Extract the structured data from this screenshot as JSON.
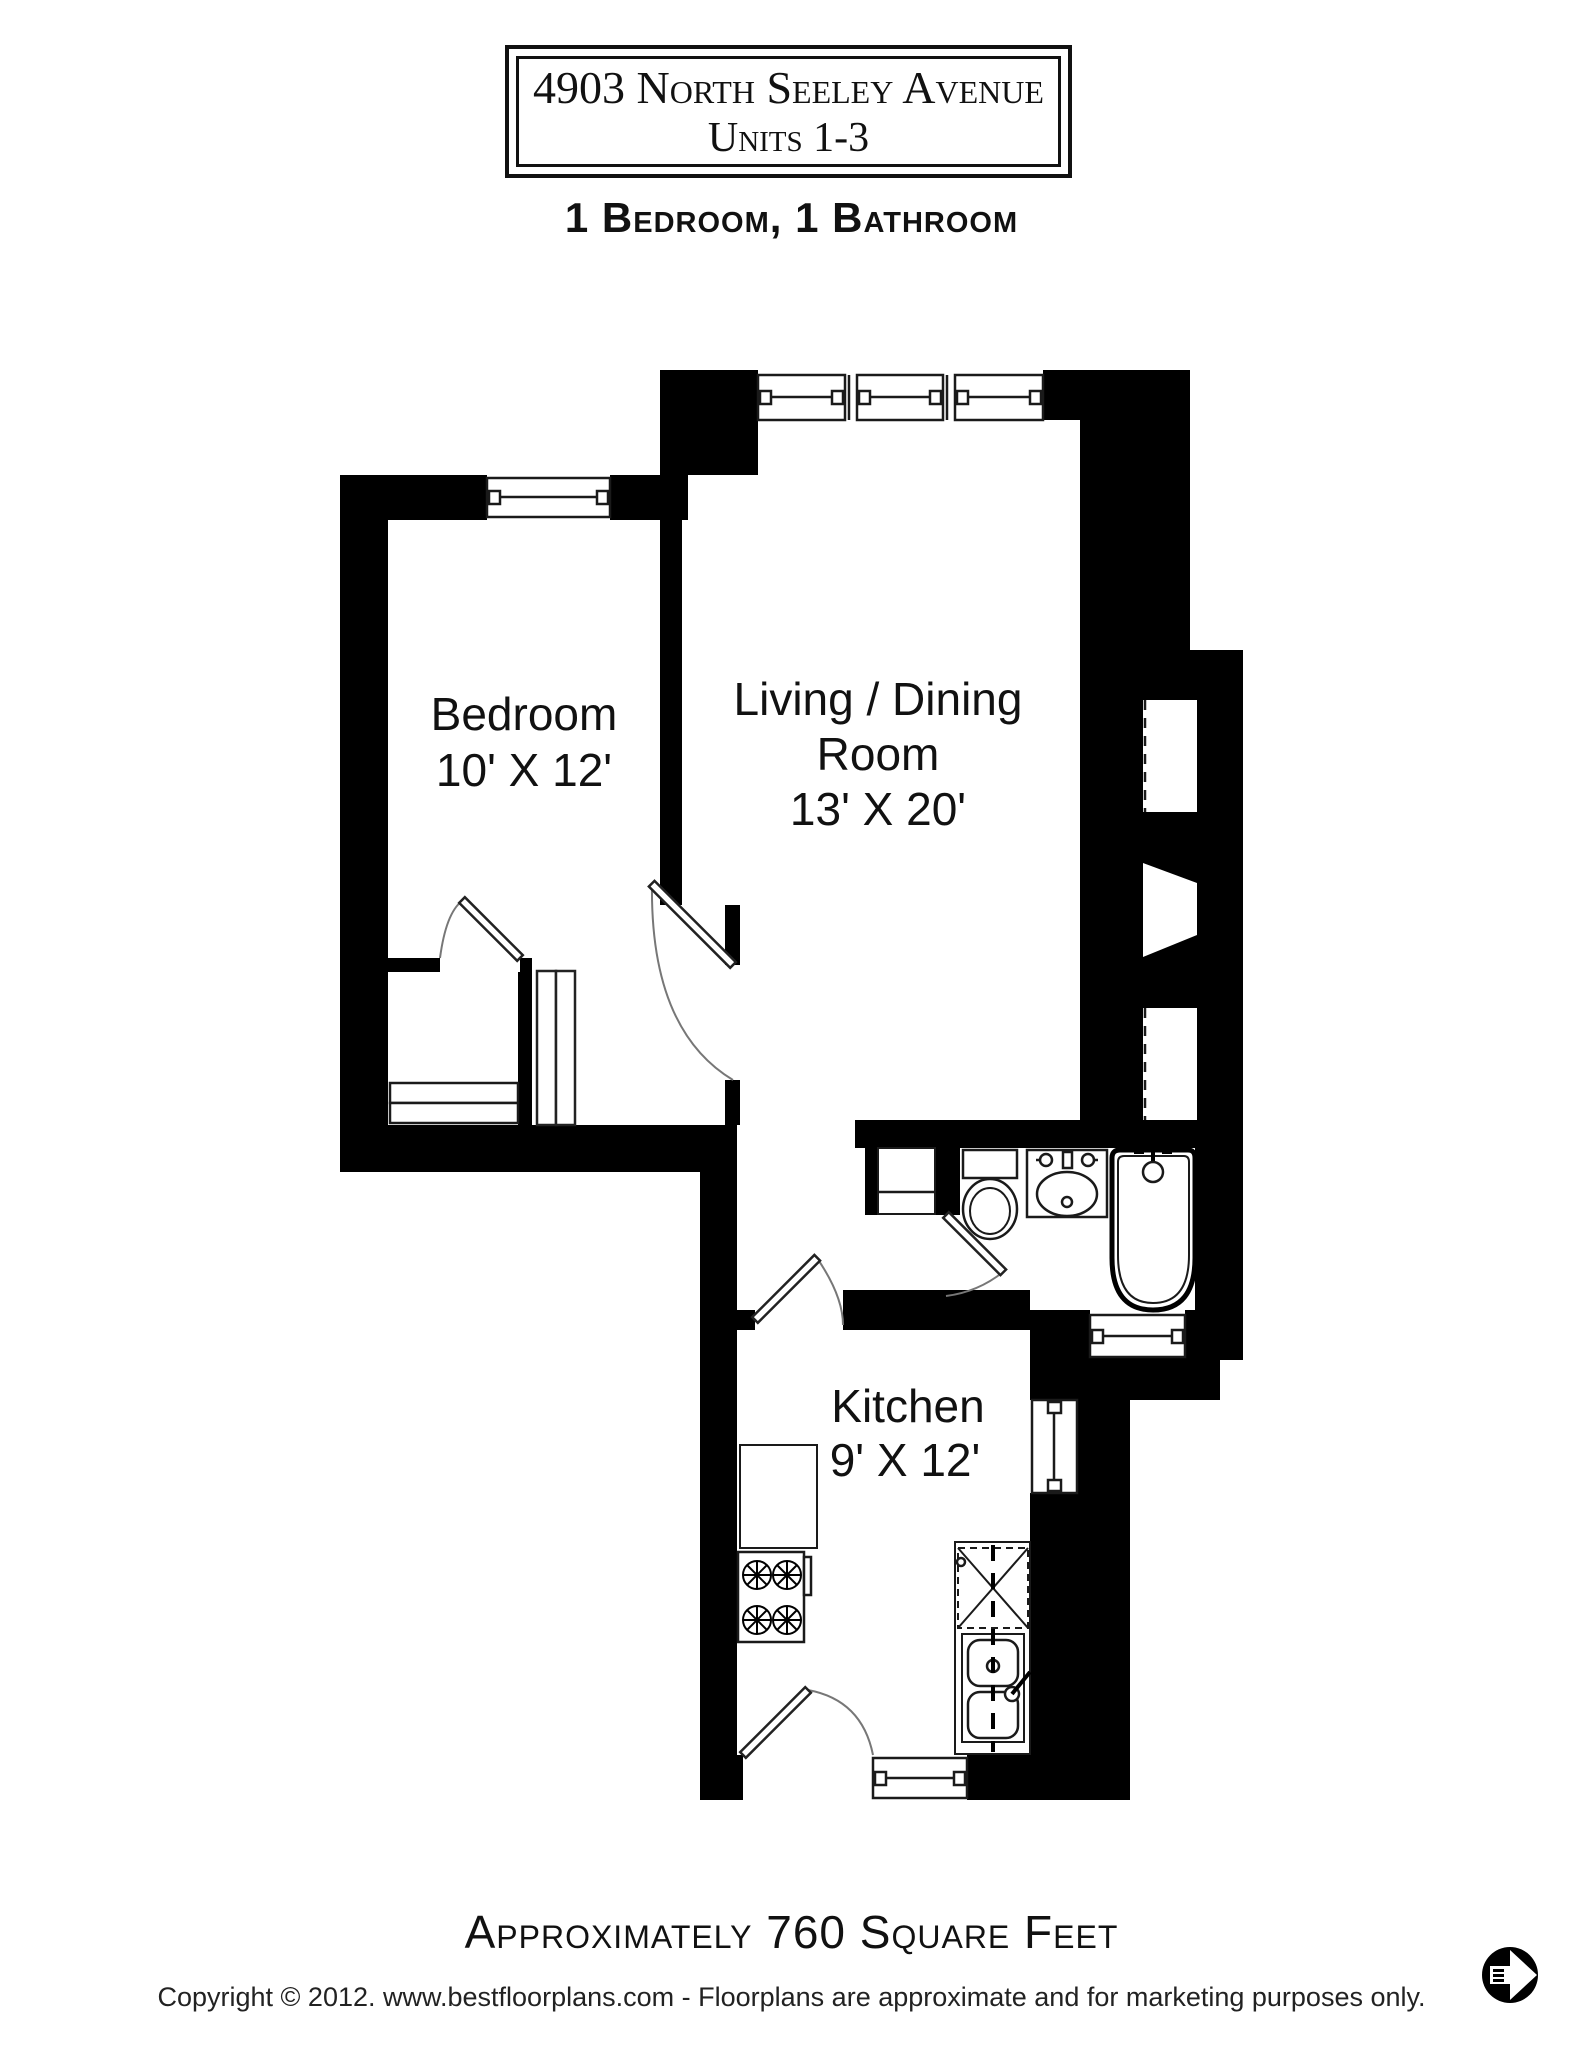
{
  "title_box": {
    "line1": "4903 North Seeley Avenue",
    "line2": "Units 1-3"
  },
  "subtitle": "1 Bedroom, 1 Bathroom",
  "floor_plan": {
    "rooms": [
      {
        "id": "bedroom",
        "name": "Bedroom",
        "dimensions": "10' X 12'"
      },
      {
        "id": "living-dining",
        "name_line1": "Living / Dining",
        "name_line2": "Room",
        "dimensions": "13' X 20'"
      },
      {
        "id": "kitchen",
        "name": "Kitchen",
        "dimensions": "9' X 12'"
      }
    ],
    "fixtures": [
      "toilet",
      "pedestal-sink",
      "bathtub",
      "stove",
      "double-kitchen-sink",
      "dishwasher",
      "counter",
      "closet-shelves"
    ],
    "window_count": 7,
    "colors": {
      "wall": "#000000",
      "floor": "#ffffff",
      "fixture_line": "#1a1a1a",
      "door_arc": "#777777"
    }
  },
  "footer": {
    "area_text": "Approximately 760 Square Feet",
    "copyright": "Copyright © 2012. www.bestfloorplans.com - Floorplans are approximate and for marketing purposes only."
  },
  "logo": {
    "name": "bestfloorplans-logo"
  }
}
